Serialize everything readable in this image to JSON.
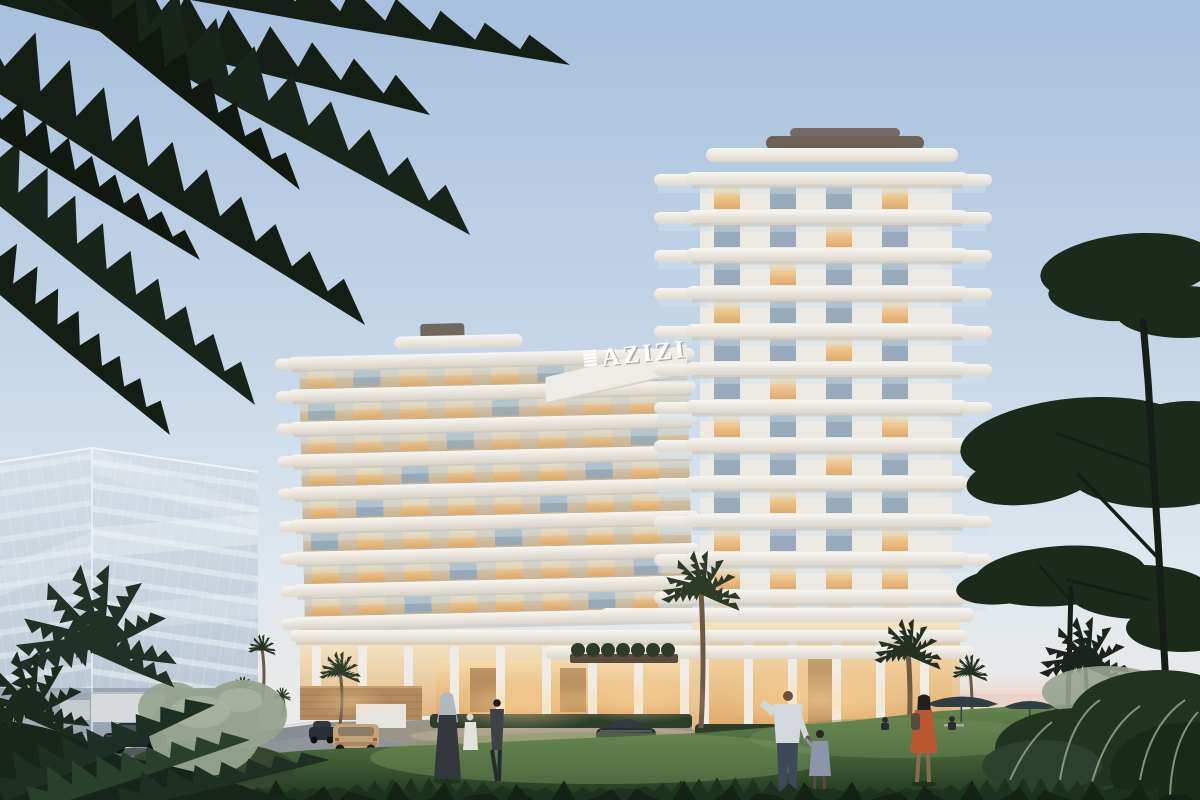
{
  "meta": {
    "type": "architectural-render",
    "time_of_day": "dusk",
    "description": "Twilight exterior rendering of the AZIZI residential building with curved white balconies, a glass office cube at left, palm trees, lawn with residents, and sunset horizon with umbrellas at right."
  },
  "sign": {
    "label": "AZIZI",
    "mark": "stacked-horizontal-bars"
  },
  "colors": {
    "sky_top": "#a7c0dd",
    "sky_mid": "#c7d7e8",
    "sky_low": "#e0e8ef",
    "sky_warm": "#f0ebe6",
    "horizon_pink": "#f3d2c3",
    "sea": "#c9d2d8",
    "glass_hi": "#d7e0e9",
    "glass_lo": "#b5c3d1",
    "slab": "#f4f2ee",
    "slab_shadow": "#c9c1b6",
    "facade_hi": "#ddcfb8",
    "facade_lo": "#c8b394",
    "window_warm_hi": "#f8dcab",
    "window_warm_lo": "#e0a765",
    "window_cool": "#93a7b8",
    "tower_face": "#edeae3",
    "railing": "#cfe2ee",
    "roof_dark": "#6e6156",
    "podium_hi": "#f4e3c4",
    "podium_lo": "#e2b784",
    "wood": "#b28a5e",
    "road": "#90959b",
    "drive": "#9b9489",
    "lawn_hi": "#6d8a52",
    "lawn_mid": "#4b6b3e",
    "lawn_dark": "#20351f",
    "foliage_dark": "#1c2a1c",
    "foliage_mid": "#2c3a27",
    "sage": "#97a38f",
    "silver_grass": "#9cab92",
    "car_dark": "#24272d",
    "car_tan": "#c3a27c",
    "skin": "#6b4f3f",
    "shirt": "#d4d8dc",
    "jeans": "#3f4859",
    "dress_orange": "#bb5834",
    "hijab_grey": "#b3b8bf",
    "dark_figure": "#23201e",
    "umbrella": "#2f3d44",
    "sign_white": "#ffffff"
  },
  "scene": {
    "residential_building": {
      "name_on_sign": "AZIZI",
      "left_wing": {
        "floors": 9
      },
      "tower": {
        "floors": 12
      },
      "podium": {
        "lobby_lit": true,
        "terrace_planters": 7
      }
    },
    "office_building": {
      "style": "glass-cube",
      "floor_lines": 13
    },
    "vehicles": [
      {
        "label": "dark-sedan-on-road"
      },
      {
        "label": "dark-hatchback"
      },
      {
        "label": "tan-suv-rear"
      },
      {
        "label": "dark-coupe-at-entrance"
      }
    ],
    "people": [
      {
        "label": "woman-in-grey-hijab"
      },
      {
        "label": "person-in-dark-outfit"
      },
      {
        "label": "woman-in-white"
      },
      {
        "label": "man-in-white-shirt"
      },
      {
        "label": "child-holding-hand"
      },
      {
        "label": "woman-in-orange-dress-with-backpack"
      },
      {
        "label": "woman-silhouette-long-hair"
      },
      {
        "label": "seated-guests-under-umbrellas",
        "count": 2
      }
    ],
    "vegetation": {
      "overhanging_palm_fronds": true,
      "palm_trees": 8,
      "pine_trees": 2,
      "sage_bushes": true,
      "lawn": true
    },
    "furniture": {
      "umbrellas": 3
    }
  }
}
